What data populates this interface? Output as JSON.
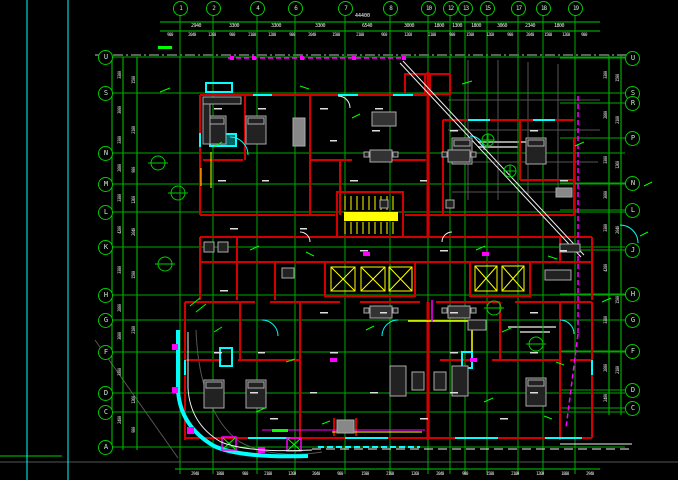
{
  "drawing": {
    "type": "architectural-floor-plan",
    "background": "#000000",
    "colors": {
      "grid": "#00c800",
      "walls": "#d40000",
      "windows": "#00ffff",
      "stairs": "#ffff00",
      "boundary": "#ff00ff",
      "furniture": "#aaaaaa",
      "roads": "#ffffff"
    }
  },
  "annotations": {
    "total_top_dimension": "44400"
  },
  "grid": {
    "top_axes": [
      [
        "1",
        180
      ],
      [
        "2",
        213
      ],
      [
        "4",
        257
      ],
      [
        "6",
        295
      ],
      [
        "7",
        345
      ],
      [
        "8",
        390
      ],
      [
        "10",
        428
      ],
      [
        "12",
        450
      ],
      [
        "13",
        465
      ],
      [
        "15",
        487
      ],
      [
        "17",
        518
      ],
      [
        "18",
        543
      ],
      [
        "19",
        575
      ]
    ],
    "left_axes": [
      [
        "U",
        57
      ],
      [
        "S",
        93
      ],
      [
        "N",
        153
      ],
      [
        "M",
        184
      ],
      [
        "L",
        212
      ],
      [
        "K",
        247
      ],
      [
        "H",
        295
      ],
      [
        "G",
        320
      ],
      [
        "F",
        352
      ],
      [
        "D",
        393
      ],
      [
        "C",
        412
      ],
      [
        "A",
        447
      ]
    ],
    "right_axes": [
      [
        "U",
        58
      ],
      [
        "S",
        93
      ],
      [
        "R",
        103
      ],
      [
        "P",
        138
      ],
      [
        "N",
        183
      ],
      [
        "L",
        210
      ],
      [
        "J",
        250
      ],
      [
        "H",
        294
      ],
      [
        "G",
        320
      ],
      [
        "F",
        351
      ],
      [
        "D",
        390
      ],
      [
        "C",
        408
      ]
    ]
  },
  "dimensions": {
    "texts": [
      {
        "t": "2940",
        "x": 196,
        "y": 26,
        "big": true
      },
      {
        "t": "3300",
        "x": 234,
        "y": 26,
        "big": true
      },
      {
        "t": "3300",
        "x": 276,
        "y": 26,
        "big": true
      },
      {
        "t": "3300",
        "x": 320,
        "y": 26,
        "big": true
      },
      {
        "t": "6540",
        "x": 367,
        "y": 26,
        "big": true
      },
      {
        "t": "3000",
        "x": 409,
        "y": 26,
        "big": true
      },
      {
        "t": "1800",
        "x": 439,
        "y": 26,
        "big": true
      },
      {
        "t": "1300",
        "x": 457,
        "y": 26,
        "big": true
      },
      {
        "t": "1800",
        "x": 476,
        "y": 26,
        "big": true
      },
      {
        "t": "3060",
        "x": 502,
        "y": 26,
        "big": true
      },
      {
        "t": "2340",
        "x": 530,
        "y": 26,
        "big": true
      },
      {
        "t": "1800",
        "x": 559,
        "y": 26,
        "big": true
      },
      {
        "t": "900",
        "x": 170,
        "y": 35
      },
      {
        "t": "2040",
        "x": 192,
        "y": 35
      },
      {
        "t": "1260",
        "x": 212,
        "y": 35
      },
      {
        "t": "900",
        "x": 232,
        "y": 35
      },
      {
        "t": "2100",
        "x": 252,
        "y": 35
      },
      {
        "t": "1200",
        "x": 272,
        "y": 35
      },
      {
        "t": "900",
        "x": 292,
        "y": 35
      },
      {
        "t": "2040",
        "x": 312,
        "y": 35
      },
      {
        "t": "1500",
        "x": 336,
        "y": 35
      },
      {
        "t": "2100",
        "x": 360,
        "y": 35
      },
      {
        "t": "960",
        "x": 384,
        "y": 35
      },
      {
        "t": "1260",
        "x": 408,
        "y": 35
      },
      {
        "t": "2100",
        "x": 432,
        "y": 35
      },
      {
        "t": "900",
        "x": 452,
        "y": 35
      },
      {
        "t": "1500",
        "x": 470,
        "y": 35
      },
      {
        "t": "1260",
        "x": 490,
        "y": 35
      },
      {
        "t": "900",
        "x": 510,
        "y": 35
      },
      {
        "t": "2040",
        "x": 530,
        "y": 35
      },
      {
        "t": "1500",
        "x": 548,
        "y": 35
      },
      {
        "t": "1260",
        "x": 566,
        "y": 35
      },
      {
        "t": "900",
        "x": 584,
        "y": 35
      },
      {
        "t": "2940",
        "x": 195,
        "y": 474
      },
      {
        "t": "1800",
        "x": 220,
        "y": 474
      },
      {
        "t": "900",
        "x": 245,
        "y": 474
      },
      {
        "t": "2100",
        "x": 268,
        "y": 474
      },
      {
        "t": "1260",
        "x": 292,
        "y": 474
      },
      {
        "t": "2040",
        "x": 316,
        "y": 474
      },
      {
        "t": "900",
        "x": 340,
        "y": 474
      },
      {
        "t": "1500",
        "x": 365,
        "y": 474
      },
      {
        "t": "2100",
        "x": 390,
        "y": 474
      },
      {
        "t": "1260",
        "x": 415,
        "y": 474
      },
      {
        "t": "2040",
        "x": 440,
        "y": 474
      },
      {
        "t": "900",
        "x": 465,
        "y": 474
      },
      {
        "t": "1500",
        "x": 490,
        "y": 474
      },
      {
        "t": "2100",
        "x": 515,
        "y": 474
      },
      {
        "t": "1260",
        "x": 540,
        "y": 474
      },
      {
        "t": "1800",
        "x": 565,
        "y": 474
      },
      {
        "t": "2940",
        "x": 590,
        "y": 474
      },
      {
        "t": "3300",
        "x": 120,
        "y": 75,
        "rot": true
      },
      {
        "t": "3000",
        "x": 120,
        "y": 110,
        "rot": true
      },
      {
        "t": "3300",
        "x": 120,
        "y": 140,
        "rot": true
      },
      {
        "t": "2800",
        "x": 120,
        "y": 168,
        "rot": true
      },
      {
        "t": "3300",
        "x": 120,
        "y": 198,
        "rot": true
      },
      {
        "t": "4200",
        "x": 120,
        "y": 230,
        "rot": true
      },
      {
        "t": "3300",
        "x": 120,
        "y": 270,
        "rot": true
      },
      {
        "t": "2800",
        "x": 120,
        "y": 308,
        "rot": true
      },
      {
        "t": "3000",
        "x": 120,
        "y": 336,
        "rot": true
      },
      {
        "t": "3300",
        "x": 120,
        "y": 372,
        "rot": true
      },
      {
        "t": "2400",
        "x": 120,
        "y": 420,
        "rot": true
      },
      {
        "t": "1500",
        "x": 134,
        "y": 80,
        "rot": true
      },
      {
        "t": "2100",
        "x": 134,
        "y": 130,
        "rot": true
      },
      {
        "t": "900",
        "x": 134,
        "y": 170,
        "rot": true
      },
      {
        "t": "1260",
        "x": 134,
        "y": 200,
        "rot": true
      },
      {
        "t": "2040",
        "x": 134,
        "y": 232,
        "rot": true
      },
      {
        "t": "1500",
        "x": 134,
        "y": 275,
        "rot": true
      },
      {
        "t": "2100",
        "x": 134,
        "y": 330,
        "rot": true
      },
      {
        "t": "1260",
        "x": 134,
        "y": 400,
        "rot": true
      },
      {
        "t": "900",
        "x": 134,
        "y": 430,
        "rot": true
      },
      {
        "t": "3300",
        "x": 606,
        "y": 75,
        "rot": true
      },
      {
        "t": "2800",
        "x": 606,
        "y": 115,
        "rot": true
      },
      {
        "t": "3300",
        "x": 606,
        "y": 160,
        "rot": true
      },
      {
        "t": "3000",
        "x": 606,
        "y": 195,
        "rot": true
      },
      {
        "t": "3300",
        "x": 606,
        "y": 228,
        "rot": true
      },
      {
        "t": "4200",
        "x": 606,
        "y": 268,
        "rot": true
      },
      {
        "t": "3300",
        "x": 606,
        "y": 320,
        "rot": true
      },
      {
        "t": "2800",
        "x": 606,
        "y": 368,
        "rot": true
      },
      {
        "t": "2400",
        "x": 606,
        "y": 398,
        "rot": true
      },
      {
        "t": "1500",
        "x": 618,
        "y": 78,
        "rot": true
      },
      {
        "t": "2100",
        "x": 618,
        "y": 120,
        "rot": true
      },
      {
        "t": "1260",
        "x": 618,
        "y": 165,
        "rot": true
      },
      {
        "t": "2040",
        "x": 618,
        "y": 230,
        "rot": true
      },
      {
        "t": "1500",
        "x": 618,
        "y": 300,
        "rot": true
      },
      {
        "t": "2100",
        "x": 618,
        "y": 370,
        "rot": true
      }
    ]
  }
}
